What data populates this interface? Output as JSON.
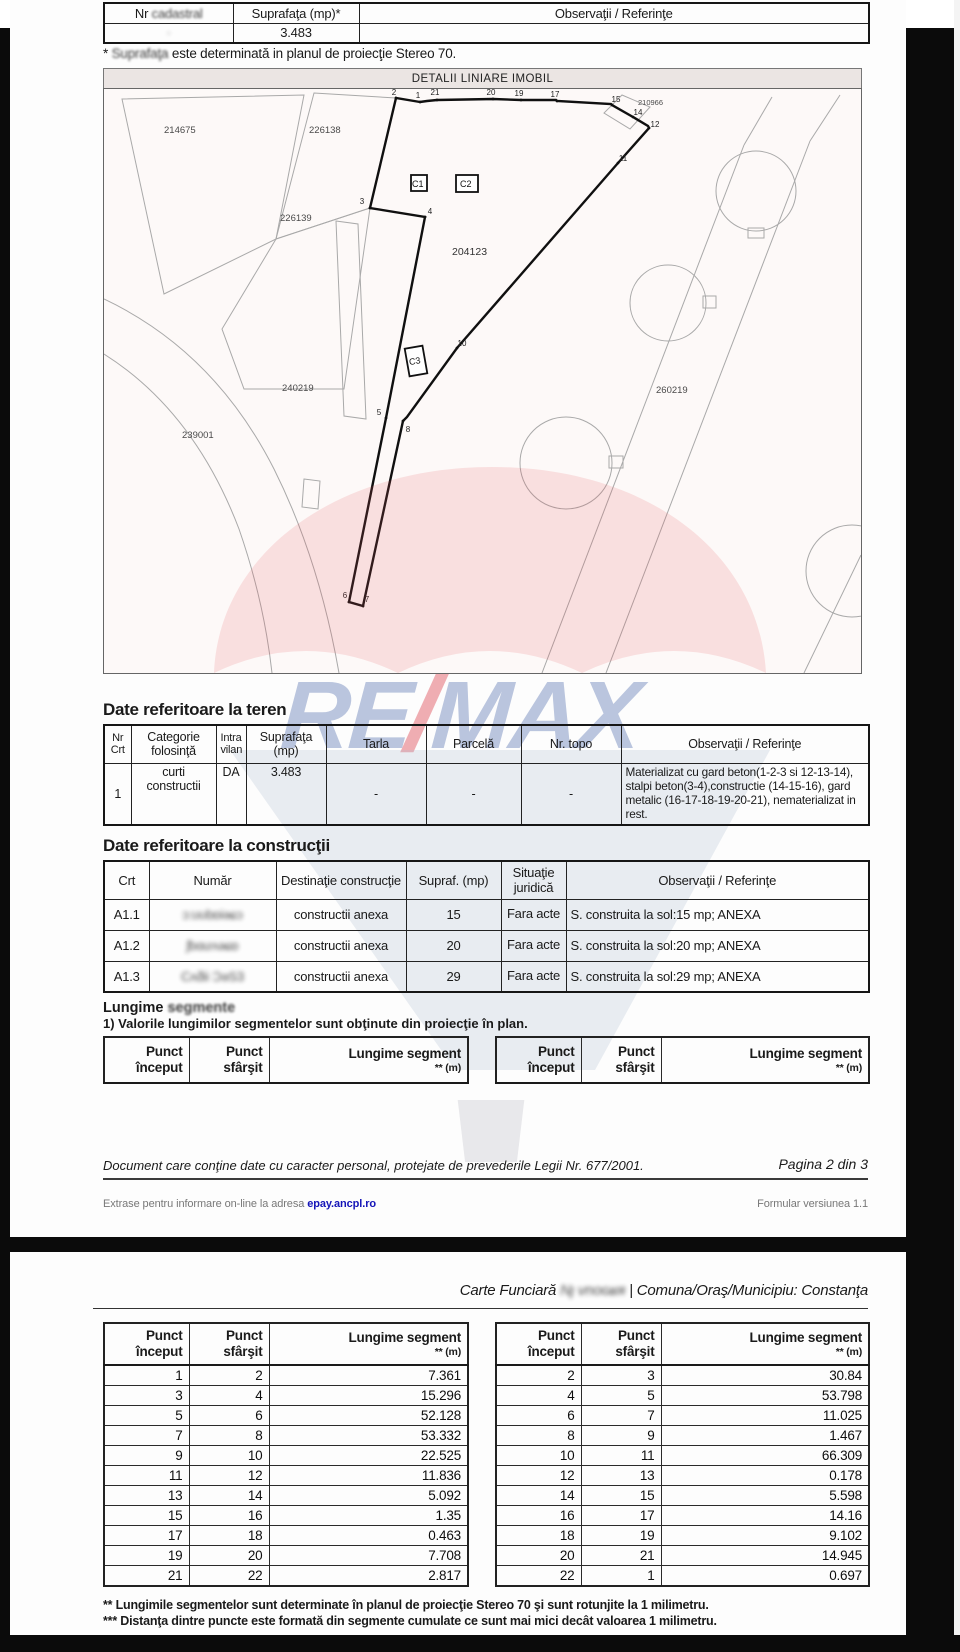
{
  "colors": {
    "watermark_red": "#e05560",
    "watermark_blue": "#5570b0",
    "watermark_gray": "#aebcd2",
    "link_blue": "#1414b8"
  },
  "page1": {
    "top_table": {
      "h_nr_pre": "Nr ",
      "h_nr_word": "cadastral",
      "h_supraf": "Suprafaţa (mp)*",
      "h_obs": "Observaţii / Referinţe",
      "nr_value": "·",
      "supraf_value": "3.483",
      "obs_value": ""
    },
    "note_star": "* ",
    "note_word": "Suprafaţa ",
    "note_rest": "este determinată in planul de proiecţie Stereo 70.",
    "map": {
      "title": "DETALII LINIARE IMOBIL",
      "parcels": {
        "p214675": "214675",
        "p226138": "226138",
        "p226139": "226139",
        "p204123": "204123",
        "p210966": "210966",
        "p240219": "240219",
        "p260219": "260219",
        "p239001": "239001"
      },
      "constructions": {
        "c1": "C1",
        "c2": "C2",
        "c3": "C3"
      },
      "vertex_labels": [
        "1",
        "2",
        "3",
        "4",
        "5",
        "6",
        "7",
        "8",
        "9",
        "10",
        "11",
        "12",
        "13",
        "14",
        "15",
        "16",
        "17",
        "18",
        "19",
        "20",
        "21",
        "22"
      ]
    },
    "watermark": {
      "re": "RE",
      "slash": "/",
      "max": "MAX"
    },
    "teren": {
      "heading": "Date referitoare la teren",
      "h": [
        "Nr Crt",
        "Categorie folosinţă",
        "Intra vilan",
        "Suprafaţa (mp)",
        "Tarla",
        "Parcelă",
        "Nr. topo",
        "Observaţii / Referinţe"
      ],
      "row": {
        "nr": "1",
        "categorie": "curti constructii",
        "intra": "DA",
        "supraf": "3.483",
        "tarla": "-",
        "parcela": "-",
        "topo": "-",
        "obs": "Materializat cu gard beton(1-2-3 si 12-13-14),  stalpi  beton(3-4),constructie (14-15-16), gard metalic (16-17-18-19-20-21), nematerializat in rest."
      }
    },
    "constructii": {
      "heading": "Date referitoare la construcţii",
      "h": [
        "Crt",
        "Număr",
        "Destinaţie construcţie",
        "Supraf. (mp)",
        "Situaţie juridică",
        "Observaţii / Referinţe"
      ],
      "rows": [
        {
          "crt": "A1.1",
          "numar": "ɔ:ʊʊbɒiəɕɔ",
          "destinatie": "constructii anexa",
          "supraf": "15",
          "situatie": "Fara acte",
          "obs": "S. construita la sol:15 mp;  ANEXA"
        },
        {
          "crt": "A1.2",
          "numar": "ʃbɑưʌəɕɒ",
          "destinatie": "constructii anexa",
          "supraf": "20",
          "situatie": "Fara acte",
          "obs": "S. construita la sol:20 mp;  ANEXA"
        },
        {
          "crt": "A1.3",
          "numar": "Cʌƌii ƆəS3",
          "destinatie": "constructii anexa",
          "supraf": "29",
          "situatie": "Fara acte",
          "obs": "S. construita la sol:29 mp;  ANEXA"
        }
      ]
    },
    "lungime": {
      "heading_a": "Lungime ",
      "heading_b": "segmente",
      "note": "1) Valorile lungimilor segmentelor sunt obţinute din proiecţie în plan.",
      "col_p1": "Punct început",
      "col_p2": "Punct sfârşit",
      "col_seg": "Lungime segment",
      "col_unit": "** (m)"
    },
    "footer": {
      "privacy": "Document care conţine date cu caracter personal, protejate de prevederile Legii Nr. 677/2001.",
      "pagina": "Pagina 2 din 3",
      "extras": "Extrase pentru informare on-line la adresa ",
      "link": "epay.ancpl.ro",
      "formular": "Formular versiunea 1.1"
    }
  },
  "page2": {
    "header": {
      "prefix": "Carte Funciară ",
      "redacted": "Nȷ vnᴏɢʁя ",
      "sep": "| ",
      "rest": "Comuna/Oraş/Municipiu: Constanţa"
    },
    "cols": {
      "p1": "Punct început",
      "p2": "Punct sfârşit",
      "seg": "Lungime segment",
      "unit": "** (m)"
    },
    "left_rows": [
      [
        "1",
        "2",
        "7.361"
      ],
      [
        "3",
        "4",
        "15.296"
      ],
      [
        "5",
        "6",
        "52.128"
      ],
      [
        "7",
        "8",
        "53.332"
      ],
      [
        "9",
        "10",
        "22.525"
      ],
      [
        "11",
        "12",
        "11.836"
      ],
      [
        "13",
        "14",
        "5.092"
      ],
      [
        "15",
        "16",
        "1.35"
      ],
      [
        "17",
        "18",
        "0.463"
      ],
      [
        "19",
        "20",
        "7.708"
      ],
      [
        "21",
        "22",
        "2.817"
      ]
    ],
    "right_rows": [
      [
        "2",
        "3",
        "30.84"
      ],
      [
        "4",
        "5",
        "53.798"
      ],
      [
        "6",
        "7",
        "11.025"
      ],
      [
        "8",
        "9",
        "1.467"
      ],
      [
        "10",
        "11",
        "66.309"
      ],
      [
        "12",
        "13",
        "0.178"
      ],
      [
        "14",
        "15",
        "5.598"
      ],
      [
        "16",
        "17",
        "14.16"
      ],
      [
        "18",
        "19",
        "9.102"
      ],
      [
        "20",
        "21",
        "14.945"
      ],
      [
        "22",
        "1",
        "0.697"
      ]
    ],
    "fn2": "** Lungimile segmentelor sunt determinate în planul de proiecţie Stereo 70 şi sunt rotunjite la 1 milimetru.",
    "fn3": "*** Distanţa dintre puncte este formată din segmente cumulate ce sunt mai mici decât valoarea 1 milimetru."
  }
}
